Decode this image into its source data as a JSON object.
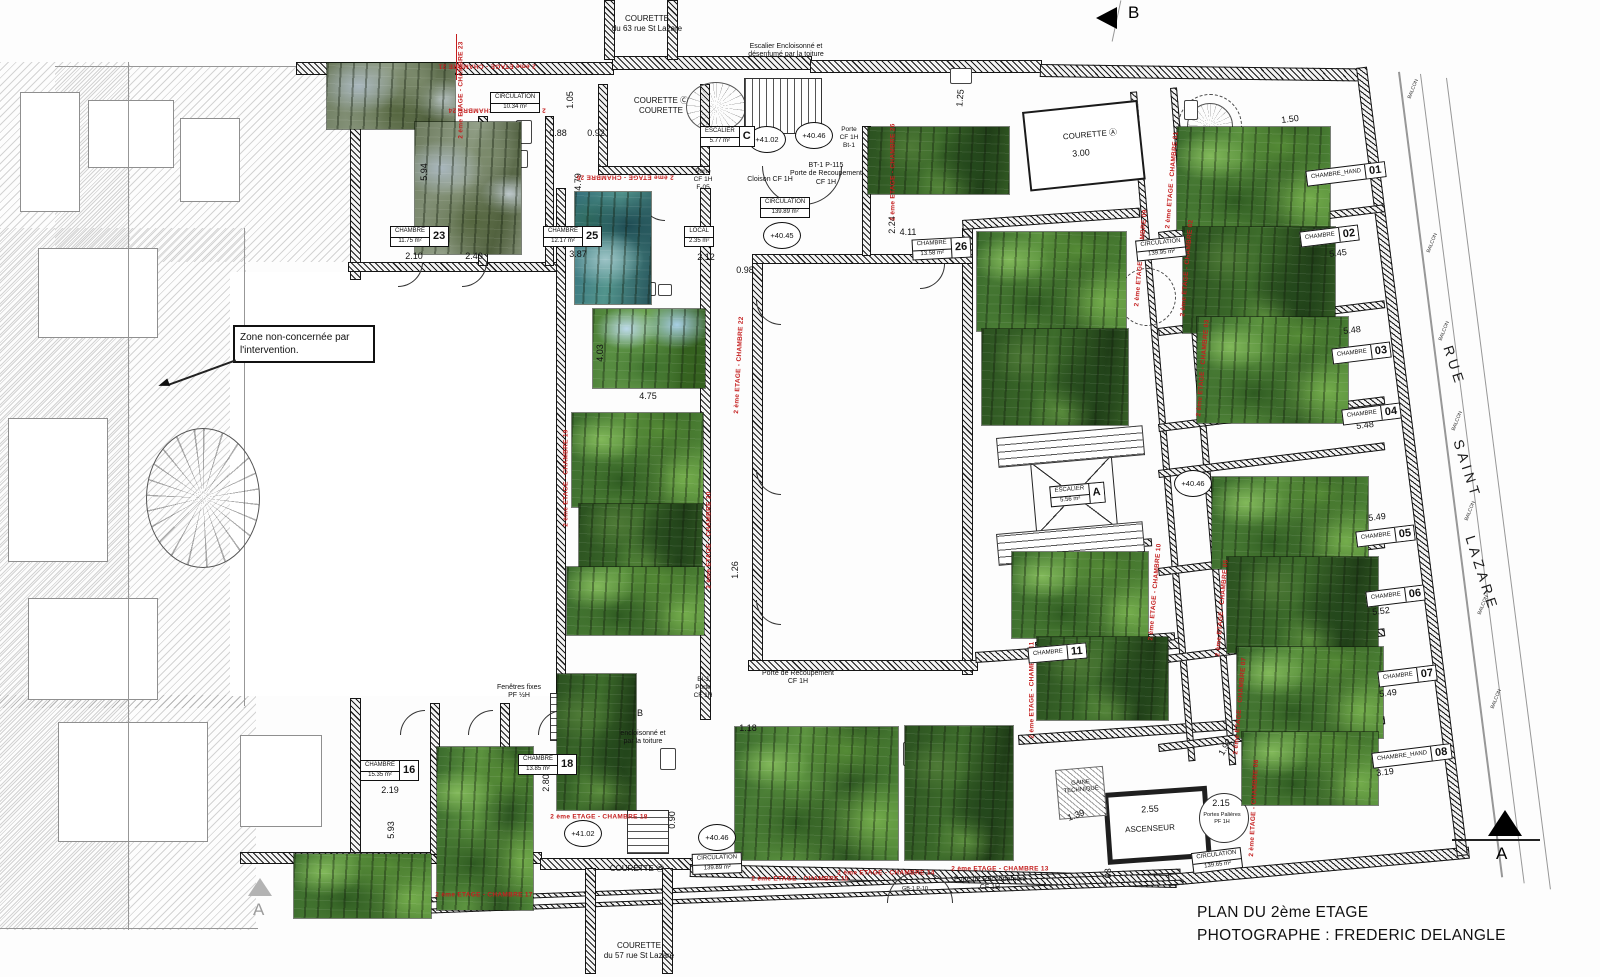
{
  "title": {
    "line1": "PLAN DU 2ème ETAGE",
    "line2": "PHOTOGRAPHE : FREDERIC DELANGLE"
  },
  "zone_note": "Zone non-concernée par l'intervention.",
  "section_markers": {
    "top": "B",
    "bottom_right": "A",
    "bottom_left": "A"
  },
  "colors": {
    "annotation_red": "#c41e1e",
    "line_black": "#1a1a1a"
  },
  "street": [
    {
      "t": "RUE",
      "x": 1448,
      "y": 338,
      "r": 72
    },
    {
      "t": "SAINT",
      "x": 1458,
      "y": 432,
      "r": 72
    },
    {
      "t": "LAZARE",
      "x": 1470,
      "y": 528,
      "r": 72
    }
  ],
  "balconies": [
    {
      "t": "BALCON",
      "x": 1403,
      "y": 86,
      "r": -68
    },
    {
      "t": "BALCON",
      "x": 1422,
      "y": 240,
      "r": -68
    },
    {
      "t": "BALCON",
      "x": 1434,
      "y": 328,
      "r": -68
    },
    {
      "t": "BALCON",
      "x": 1447,
      "y": 418,
      "r": -68
    },
    {
      "t": "BALCON",
      "x": 1460,
      "y": 508,
      "r": -68
    },
    {
      "t": "BALCON",
      "x": 1473,
      "y": 602,
      "r": -68
    },
    {
      "t": "BALCON",
      "x": 1486,
      "y": 696,
      "r": -68
    }
  ],
  "level_markers": [
    {
      "t": "+41.02",
      "x": 748,
      "y": 126
    },
    {
      "t": "+40.46",
      "x": 795,
      "y": 122
    },
    {
      "t": "+40.45",
      "x": 763,
      "y": 222
    },
    {
      "t": "+40.46",
      "x": 1174,
      "y": 470
    },
    {
      "t": "+41.02",
      "x": 564,
      "y": 820
    },
    {
      "t": "+40.46",
      "x": 698,
      "y": 824
    }
  ],
  "tags": [
    {
      "title": "CHAMBRE",
      "sub": "11.75 m²",
      "num": "23",
      "x": 390,
      "y": 226,
      "r": 0
    },
    {
      "title": "CHAMBRE",
      "sub": "12.17 m²",
      "num": "25",
      "x": 543,
      "y": 226,
      "r": 0
    },
    {
      "title": "CHAMBRE",
      "sub": "13.58 m²",
      "num": "26",
      "x": 912,
      "y": 238,
      "r": -3
    },
    {
      "title": "CHAMBRE",
      "sub": "15.35 m²",
      "num": "16",
      "x": 360,
      "y": 760,
      "r": 0
    },
    {
      "title": "CHAMBRE",
      "sub": "13.85 m²",
      "num": "18",
      "x": 518,
      "y": 754,
      "r": 0
    },
    {
      "title": "CHAMBRE_HAND",
      "sub": "",
      "num": "01",
      "x": 1306,
      "y": 166,
      "r": -7
    },
    {
      "title": "CHAMBRE",
      "sub": "",
      "num": "02",
      "x": 1300,
      "y": 228,
      "r": -7
    },
    {
      "title": "CHAMBRE",
      "sub": "",
      "num": "03",
      "x": 1332,
      "y": 345,
      "r": -7
    },
    {
      "title": "CHAMBRE",
      "sub": "",
      "num": "04",
      "x": 1342,
      "y": 406,
      "r": -7
    },
    {
      "title": "CHAMBRE",
      "sub": "",
      "num": "05",
      "x": 1356,
      "y": 528,
      "r": -7
    },
    {
      "title": "CHAMBRE",
      "sub": "",
      "num": "06",
      "x": 1366,
      "y": 588,
      "r": -7
    },
    {
      "title": "CHAMBRE",
      "sub": "",
      "num": "07",
      "x": 1378,
      "y": 668,
      "r": -7
    },
    {
      "title": "CHAMBRE_HAND",
      "sub": "",
      "num": "08",
      "x": 1372,
      "y": 748,
      "r": -7
    },
    {
      "title": "CHAMBRE",
      "sub": "",
      "num": "11",
      "x": 1028,
      "y": 645,
      "r": -5
    },
    {
      "title": "CIRCULATION",
      "sub": "10.34 m²",
      "num": "",
      "x": 490,
      "y": 92,
      "r": 0
    },
    {
      "title": "CIRCULATION",
      "sub": "139.89 m²",
      "num": "",
      "x": 760,
      "y": 197,
      "r": 0
    },
    {
      "title": "CIRCULATION",
      "sub": "139.95 m²",
      "num": "",
      "x": 1136,
      "y": 238,
      "r": -6
    },
    {
      "title": "CIRCULATION",
      "sub": "139.89 m²",
      "num": "",
      "x": 692,
      "y": 853,
      "r": -2
    },
    {
      "title": "CIRCULATION",
      "sub": "139.65 m²",
      "num": "",
      "x": 1192,
      "y": 850,
      "r": -7
    },
    {
      "title": "ESCALIER",
      "sub": "5.77 m²",
      "num": "C",
      "x": 700,
      "y": 126,
      "r": 0
    },
    {
      "title": "ESCALIER",
      "sub": "5.56 m²",
      "num": "A",
      "x": 1050,
      "y": 484,
      "r": -5
    },
    {
      "title": "LOCAL",
      "sub": "2.35 m²",
      "num": "",
      "x": 684,
      "y": 226,
      "r": 0
    }
  ],
  "labels": [
    {
      "lines": [
        "COURETTE",
        "du 63 rue St Lazare"
      ],
      "x": 647,
      "y": 14,
      "s": 8,
      "r": 0
    },
    {
      "lines": [
        "Escalier Encloisonné et",
        "désenfumé par la toiture"
      ],
      "x": 786,
      "y": 43,
      "s": 7,
      "r": 0
    },
    {
      "lines": [
        "COURETTE Ⓒ",
        "COURETTE"
      ],
      "x": 661,
      "y": 96,
      "s": 8,
      "r": 0
    },
    {
      "lines": [
        "COURETTE Ⓐ"
      ],
      "x": 1090,
      "y": 130,
      "s": 8,
      "r": -5
    },
    {
      "lines": [
        "COURETTE Ⓑ"
      ],
      "x": 637,
      "y": 864,
      "s": 8,
      "r": 0
    },
    {
      "lines": [
        "COURETTE",
        "du 57 rue St Lazare"
      ],
      "x": 639,
      "y": 941,
      "s": 8,
      "r": 0
    },
    {
      "lines": [
        "GAINE",
        "TECHNIQUE"
      ],
      "x": 1081,
      "y": 780,
      "s": 6,
      "r": -5
    },
    {
      "lines": [
        "ASCENSEUR"
      ],
      "x": 1150,
      "y": 824,
      "s": 8,
      "r": -3
    },
    {
      "lines": [
        "Portes Palières",
        "PF 1H"
      ],
      "x": 1222,
      "y": 812,
      "s": 5.5,
      "r": 0
    },
    {
      "lines": [
        "BT-1   P-115",
        "Porte de Recoupement",
        "CF 1H"
      ],
      "x": 826,
      "y": 162,
      "s": 7,
      "r": 0
    },
    {
      "lines": [
        "Porte de Recoupement",
        "CF 1H"
      ],
      "x": 798,
      "y": 670,
      "s": 7,
      "r": 0
    },
    {
      "lines": [
        "Porte de Recoupement",
        "CF 1H"
      ],
      "x": 990,
      "y": 876,
      "s": 7,
      "r": 0
    },
    {
      "lines": [
        "Porte",
        "CF 1H",
        "Bt-1"
      ],
      "x": 849,
      "y": 126,
      "s": 6.5,
      "r": 0
    },
    {
      "lines": [
        "Porte",
        "CF 1H",
        "F-05"
      ],
      "x": 703,
      "y": 168,
      "s": 6.5,
      "r": 0
    },
    {
      "lines": [
        "Cloison CF 1H"
      ],
      "x": 770,
      "y": 176,
      "s": 7,
      "r": 0
    },
    {
      "lines": [
        "BI-J",
        "Porte",
        "CF 1H"
      ],
      "x": 703,
      "y": 676,
      "s": 6.5,
      "r": 0
    },
    {
      "lines": [
        "Fenêtres fixes",
        "PF ½H"
      ],
      "x": 519,
      "y": 684,
      "s": 7,
      "r": 0
    },
    {
      "lines": [
        "encloisonné et",
        "par la toiture"
      ],
      "x": 643,
      "y": 730,
      "s": 7,
      "r": 0
    },
    {
      "lines": [
        "B"
      ],
      "x": 640,
      "y": 708,
      "s": 9,
      "r": 0
    },
    {
      "lines": [
        "GB-1  P-10"
      ],
      "x": 915,
      "y": 886,
      "s": 5.5,
      "r": 0
    }
  ],
  "dimensions": [
    {
      "t": "5.94",
      "x": 424,
      "y": 172,
      "r": -90
    },
    {
      "t": "1.05",
      "x": 570,
      "y": 100,
      "r": -90
    },
    {
      "t": "0.88",
      "x": 558,
      "y": 133,
      "r": 0
    },
    {
      "t": "0.92",
      "x": 596,
      "y": 133,
      "r": 0
    },
    {
      "t": "2.10",
      "x": 414,
      "y": 256,
      "r": 0
    },
    {
      "t": "2.40",
      "x": 474,
      "y": 256,
      "r": 0
    },
    {
      "t": "3.87",
      "x": 578,
      "y": 254,
      "r": 0
    },
    {
      "t": "4.79",
      "x": 578,
      "y": 182,
      "r": -90
    },
    {
      "t": "2.12",
      "x": 706,
      "y": 257,
      "r": 0
    },
    {
      "t": "0.98",
      "x": 745,
      "y": 270,
      "r": 0
    },
    {
      "t": "2.24",
      "x": 892,
      "y": 225,
      "r": -90
    },
    {
      "t": "4.11",
      "x": 908,
      "y": 232,
      "r": 0
    },
    {
      "t": "1.25",
      "x": 960,
      "y": 98,
      "r": -85
    },
    {
      "t": "3.00",
      "x": 1081,
      "y": 153,
      "r": -5
    },
    {
      "t": "1.50",
      "x": 1290,
      "y": 119,
      "r": -7
    },
    {
      "t": "5.45",
      "x": 1338,
      "y": 253,
      "r": -7
    },
    {
      "t": "5.48",
      "x": 1352,
      "y": 330,
      "r": -7
    },
    {
      "t": "5.48",
      "x": 1365,
      "y": 425,
      "r": -7
    },
    {
      "t": "5.49",
      "x": 1377,
      "y": 517,
      "r": -7
    },
    {
      "t": "5.52",
      "x": 1381,
      "y": 611,
      "r": -7
    },
    {
      "t": "5.49",
      "x": 1388,
      "y": 693,
      "r": -7
    },
    {
      "t": "3.19",
      "x": 1385,
      "y": 772,
      "r": -7
    },
    {
      "t": "4.03",
      "x": 600,
      "y": 353,
      "r": -90
    },
    {
      "t": "4.75",
      "x": 648,
      "y": 396,
      "r": 0
    },
    {
      "t": "1.26",
      "x": 735,
      "y": 570,
      "r": -90
    },
    {
      "t": "1.18",
      "x": 748,
      "y": 728,
      "r": 0
    },
    {
      "t": "2.19",
      "x": 390,
      "y": 790,
      "r": 0
    },
    {
      "t": "5.93",
      "x": 391,
      "y": 830,
      "r": -90
    },
    {
      "t": "2.80",
      "x": 546,
      "y": 783,
      "r": -90
    },
    {
      "t": "0.90",
      "x": 672,
      "y": 820,
      "r": -90
    },
    {
      "t": "2.55",
      "x": 1150,
      "y": 809,
      "r": -3
    },
    {
      "t": "1.39",
      "x": 1076,
      "y": 815,
      "r": -20
    },
    {
      "t": "1.03",
      "x": 1108,
      "y": 877,
      "r": -90
    },
    {
      "t": "1.92",
      "x": 1225,
      "y": 747,
      "r": -60
    },
    {
      "t": "2.15",
      "x": 1221,
      "y": 803,
      "r": 0
    }
  ],
  "red_captions": [
    {
      "t": "2 ème ETAGE - CHAMBRE 21",
      "x": 487,
      "y": 66,
      "r": 180
    },
    {
      "t": "2 ème ETAGE - CHAMBRE 23",
      "x": 461,
      "y": 90,
      "r": -90
    },
    {
      "t": "2 ème ETAGE - CHAMBRE 24",
      "x": 497,
      "y": 110,
      "r": 180
    },
    {
      "t": "2 ème ETAGE - CHAMBRE 25",
      "x": 625,
      "y": 177,
      "r": 180
    },
    {
      "t": "2 ème ETAGE - CHAMBRE 22",
      "x": 739,
      "y": 365,
      "r": -87
    },
    {
      "t": "2 ème ETAGE - CHAMBRE 19",
      "x": 566,
      "y": 478,
      "r": -90
    },
    {
      "t": "2 ème ETAGE - CHAMBRE 20",
      "x": 709,
      "y": 540,
      "r": -90
    },
    {
      "t": "2 ème ETAGE - CHAMBRE 26",
      "x": 893,
      "y": 172,
      "r": -90
    },
    {
      "t": "2 ème ETAGE - CHAMBRE 09",
      "x": 1141,
      "y": 258,
      "r": -85
    },
    {
      "t": "2 ème ETAGE - CHAMBRE 01",
      "x": 1172,
      "y": 180,
      "r": -85
    },
    {
      "t": "2 ème ETAGE - CHAMBRE 02",
      "x": 1187,
      "y": 268,
      "r": -85
    },
    {
      "t": "2 ème ETAGE - CHAMBRE 03",
      "x": 1203,
      "y": 368,
      "r": -85
    },
    {
      "t": "2 ème ETAGE - CHAMBRE 05",
      "x": 1222,
      "y": 608,
      "r": -85
    },
    {
      "t": "2 ème ETAGE - CHAMBRE 07",
      "x": 1240,
      "y": 706,
      "r": -85
    },
    {
      "t": "2 ème ETAGE - CHAMBRE 08",
      "x": 1254,
      "y": 808,
      "r": -87
    },
    {
      "t": "2 ème ETAGE - CHAMBRE 10",
      "x": 1155,
      "y": 592,
      "r": -85
    },
    {
      "t": "2 ème ETAGE - CHAMBRE 11",
      "x": 1032,
      "y": 690,
      "r": -90
    },
    {
      "t": "2 ème ETAGE - CHAMBRE 17",
      "x": 484,
      "y": 895,
      "r": 0
    },
    {
      "t": "2 ème ETAGE - CHAMBRE 18",
      "x": 599,
      "y": 817,
      "r": 0
    },
    {
      "t": "2 ème ETAGE - CHAMBRE 15",
      "x": 800,
      "y": 879,
      "r": 0
    },
    {
      "t": "2 ème ETAGE - CHAMBRE 14",
      "x": 886,
      "y": 873,
      "r": 0
    },
    {
      "t": "2 ème ETAGE - CHAMBRE 13",
      "x": 1000,
      "y": 869,
      "r": 0
    }
  ],
  "photos": [
    {
      "x": 327,
      "y": 63,
      "w": 128,
      "h": 66,
      "v": "rock"
    },
    {
      "x": 415,
      "y": 122,
      "w": 106,
      "h": 132,
      "v": "rock"
    },
    {
      "x": 575,
      "y": 192,
      "w": 76,
      "h": 112,
      "v": "pond"
    },
    {
      "x": 593,
      "y": 309,
      "w": 112,
      "h": 79,
      "v": "sky"
    },
    {
      "x": 572,
      "y": 413,
      "w": 131,
      "h": 94,
      "v": "forest"
    },
    {
      "x": 579,
      "y": 504,
      "w": 123,
      "h": 66,
      "v": "dark"
    },
    {
      "x": 567,
      "y": 567,
      "w": 137,
      "h": 68,
      "v": "forest"
    },
    {
      "x": 557,
      "y": 674,
      "w": 79,
      "h": 136,
      "v": "dark"
    },
    {
      "x": 437,
      "y": 747,
      "w": 96,
      "h": 163,
      "v": "forest"
    },
    {
      "x": 294,
      "y": 854,
      "w": 137,
      "h": 64,
      "v": "forest"
    },
    {
      "x": 735,
      "y": 727,
      "w": 163,
      "h": 133,
      "v": "forest"
    },
    {
      "x": 905,
      "y": 726,
      "w": 108,
      "h": 134,
      "v": "dark"
    },
    {
      "x": 868,
      "y": 127,
      "w": 141,
      "h": 67,
      "v": "dark"
    },
    {
      "x": 977,
      "y": 232,
      "w": 149,
      "h": 99,
      "v": "forest"
    },
    {
      "x": 982,
      "y": 329,
      "w": 146,
      "h": 96,
      "v": "dark"
    },
    {
      "x": 1012,
      "y": 552,
      "w": 136,
      "h": 86,
      "v": "forest"
    },
    {
      "x": 1037,
      "y": 637,
      "w": 131,
      "h": 83,
      "v": "dark"
    },
    {
      "x": 1177,
      "y": 127,
      "w": 153,
      "h": 103,
      "v": "forest"
    },
    {
      "x": 1183,
      "y": 227,
      "w": 152,
      "h": 106,
      "v": "dark"
    },
    {
      "x": 1197,
      "y": 317,
      "w": 151,
      "h": 106,
      "v": "forest"
    },
    {
      "x": 1212,
      "y": 477,
      "w": 156,
      "h": 92,
      "v": "forest"
    },
    {
      "x": 1227,
      "y": 557,
      "w": 151,
      "h": 96,
      "v": "dark"
    },
    {
      "x": 1237,
      "y": 647,
      "w": 146,
      "h": 91,
      "v": "forest"
    },
    {
      "x": 1242,
      "y": 732,
      "w": 136,
      "h": 73,
      "v": "forest"
    }
  ]
}
